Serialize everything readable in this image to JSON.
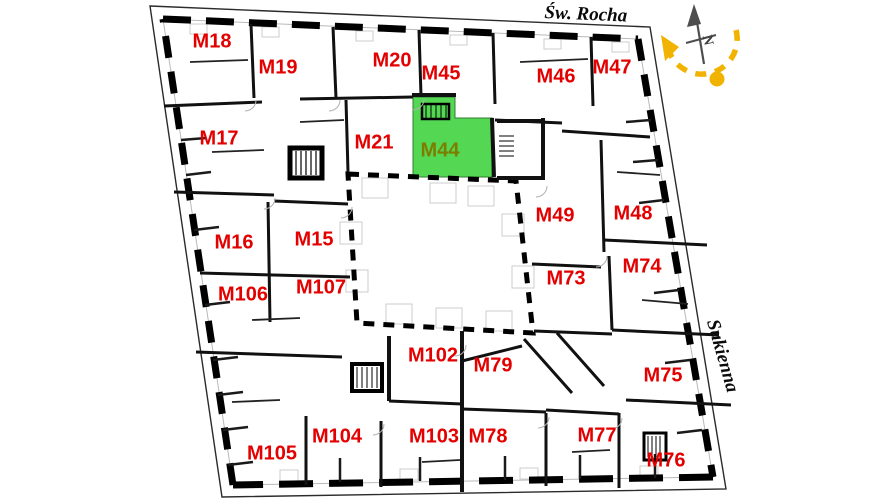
{
  "title": "Building floor plan",
  "streets": {
    "top": "Św. Rocha",
    "right": "Sukienna"
  },
  "compass": {
    "north_label": "N"
  },
  "colors": {
    "unit_label": "#e30000",
    "highlight_fill": "#54d854",
    "highlight_label": "#7d7d00",
    "sun_arc": "#f2b300",
    "walls": "#111111"
  },
  "highlighted_unit": "M44",
  "units": [
    {
      "label": "M18",
      "x": 212,
      "y": 42,
      "highlighted": false
    },
    {
      "label": "M19",
      "x": 278,
      "y": 68,
      "highlighted": false
    },
    {
      "label": "M20",
      "x": 392,
      "y": 61,
      "highlighted": false
    },
    {
      "label": "M45",
      "x": 441,
      "y": 74,
      "highlighted": false
    },
    {
      "label": "M46",
      "x": 556,
      "y": 77,
      "highlighted": false
    },
    {
      "label": "M47",
      "x": 612,
      "y": 68,
      "highlighted": false
    },
    {
      "label": "M17",
      "x": 219,
      "y": 139,
      "highlighted": false
    },
    {
      "label": "M21",
      "x": 374,
      "y": 143,
      "highlighted": false
    },
    {
      "label": "M44",
      "x": 440,
      "y": 151,
      "highlighted": true
    },
    {
      "label": "M49",
      "x": 555,
      "y": 216,
      "highlighted": false
    },
    {
      "label": "M48",
      "x": 633,
      "y": 214,
      "highlighted": false
    },
    {
      "label": "M16",
      "x": 234,
      "y": 243,
      "highlighted": false
    },
    {
      "label": "M15",
      "x": 314,
      "y": 240,
      "highlighted": false
    },
    {
      "label": "M73",
      "x": 566,
      "y": 279,
      "highlighted": false
    },
    {
      "label": "M74",
      "x": 642,
      "y": 267,
      "highlighted": false
    },
    {
      "label": "M106",
      "x": 243,
      "y": 295,
      "highlighted": false
    },
    {
      "label": "M107",
      "x": 321,
      "y": 288,
      "highlighted": false
    },
    {
      "label": "M75",
      "x": 663,
      "y": 376,
      "highlighted": false
    },
    {
      "label": "M102",
      "x": 433,
      "y": 356,
      "highlighted": false
    },
    {
      "label": "M79",
      "x": 493,
      "y": 366,
      "highlighted": false
    },
    {
      "label": "M104",
      "x": 337,
      "y": 437,
      "highlighted": false
    },
    {
      "label": "M103",
      "x": 434,
      "y": 437,
      "highlighted": false
    },
    {
      "label": "M78",
      "x": 488,
      "y": 437,
      "highlighted": false
    },
    {
      "label": "M77",
      "x": 597,
      "y": 436,
      "highlighted": false
    },
    {
      "label": "M105",
      "x": 272,
      "y": 454,
      "highlighted": false
    },
    {
      "label": "M76",
      "x": 666,
      "y": 461,
      "highlighted": false
    }
  ]
}
